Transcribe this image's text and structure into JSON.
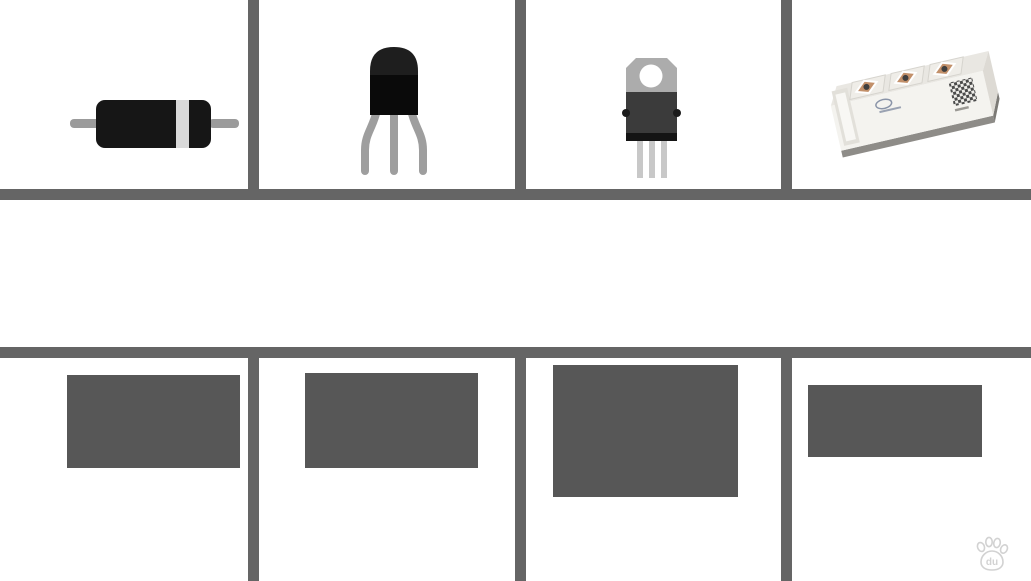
{
  "title": {
    "text": "什么是半导体",
    "color": "#5E5E5E"
  },
  "watermark": {
    "icon": "baidu-paw-icon",
    "handle": "@光淼君"
  },
  "palette": {
    "background": "#FFFFFF",
    "grid_line": "#656565",
    "title_text": "#5E5E5E",
    "diagram_border": "#575757",
    "yellow": "#F8DE4A",
    "blue": "#5B9DE2",
    "red": "#EC6A5B",
    "dark_dot": "#3D3D3D",
    "donut_ring": "#484848",
    "diode_body": "#161616",
    "diode_band": "#D9D9D9",
    "lead_gray": "#9B9B9B",
    "to92_body": "#1E1E1E",
    "to92_body_lower": "#0A0A0A",
    "to220_tab": "#ACACAC",
    "to220_body": "#3B3B3B",
    "to220_legs": "#C8C8C8",
    "module_body": "#F4F3EF",
    "module_top": "#E9E7E2",
    "module_end": "#DDDAD4",
    "module_base": "#8E8C88",
    "copper": "#C2906A"
  },
  "top_row": [
    {
      "icon": "axial-diode-icon"
    },
    {
      "icon": "to92-transistor-icon"
    },
    {
      "icon": "to220-package-icon"
    },
    {
      "icon": "igbt-power-module-icon"
    }
  ],
  "diagrams": {
    "conductor_insulator": {
      "left": {
        "bg": "yellow",
        "atom": "donut",
        "cols_pct": [
          26,
          74
        ],
        "rows_pct": [
          16,
          50,
          84
        ]
      },
      "right": {
        "bg": "blue",
        "atom": "red",
        "cols_pct": [
          28,
          72
        ],
        "rows_pct": [
          17,
          50,
          83
        ]
      }
    },
    "pn_junction": {
      "sections": [
        {
          "bg": "blue",
          "pattern": "dense-red-grid",
          "cols": 4,
          "rows": 7
        },
        {
          "bg": "yellow",
          "pattern": "scattered-dark",
          "dots_pct": [
            [
              45,
              8
            ],
            [
              75,
              23
            ],
            [
              32,
              40
            ],
            [
              68,
              55
            ],
            [
              30,
              71
            ],
            [
              62,
              88
            ]
          ]
        },
        {
          "bg": "blue",
          "pattern": "scattered-red",
          "dots_pct": [
            [
              22,
              9
            ],
            [
              80,
              9
            ],
            [
              40,
              24
            ],
            [
              58,
              24
            ],
            [
              18,
              40
            ],
            [
              84,
              42
            ],
            [
              42,
              55
            ],
            [
              58,
              55
            ],
            [
              22,
              70
            ],
            [
              86,
              70
            ],
            [
              44,
              87
            ],
            [
              58,
              87
            ]
          ]
        }
      ]
    },
    "doped_crystal": {
      "bg": "yellow",
      "wells": [
        {
          "x": 10,
          "w": 52,
          "h": 42,
          "dots_pct": [
            [
              22,
              28
            ],
            [
              76,
              28
            ],
            [
              16,
              70
            ],
            [
              48,
              70
            ],
            [
              82,
              70
            ]
          ]
        },
        {
          "x": 108,
          "w": 52,
          "h": 42,
          "dots_pct": [
            [
              20,
              28
            ],
            [
              50,
              28
            ],
            [
              80,
              28
            ],
            [
              18,
              70
            ],
            [
              72,
              70
            ]
          ]
        }
      ],
      "field_dots": [
        [
          37,
          7,
          "d"
        ],
        [
          45,
          7,
          "d"
        ],
        [
          57,
          7,
          "d"
        ],
        [
          34,
          18,
          "d"
        ],
        [
          42,
          18,
          "r"
        ],
        [
          50,
          18,
          "d"
        ],
        [
          58,
          18,
          "d"
        ],
        [
          42,
          29,
          "d"
        ],
        [
          57,
          29,
          "d"
        ],
        [
          5,
          44,
          "d"
        ],
        [
          19,
          44,
          "d"
        ],
        [
          27,
          44,
          "d"
        ],
        [
          35,
          44,
          "r"
        ],
        [
          43,
          44,
          "d"
        ],
        [
          50,
          44,
          "d"
        ],
        [
          63,
          44,
          "d"
        ],
        [
          71,
          44,
          "d"
        ],
        [
          83,
          44,
          "d"
        ],
        [
          91,
          44,
          "d"
        ],
        [
          5,
          55,
          "d"
        ],
        [
          18,
          55,
          "d"
        ],
        [
          32,
          55,
          "d"
        ],
        [
          40,
          55,
          "r"
        ],
        [
          49,
          55,
          "d"
        ],
        [
          56,
          55,
          "d"
        ],
        [
          72,
          55,
          "r"
        ],
        [
          80,
          55,
          "d"
        ],
        [
          3,
          66,
          "d"
        ],
        [
          10,
          66,
          "d"
        ],
        [
          17,
          66,
          "d"
        ],
        [
          25,
          66,
          "r"
        ],
        [
          32,
          66,
          "d"
        ],
        [
          39,
          66,
          "d"
        ],
        [
          46,
          66,
          "d"
        ],
        [
          53,
          66,
          "d"
        ],
        [
          60,
          66,
          "d"
        ],
        [
          73,
          66,
          "d"
        ],
        [
          81,
          66,
          "r"
        ],
        [
          89,
          66,
          "d"
        ],
        [
          6,
          77,
          "d"
        ],
        [
          26,
          77,
          "d"
        ],
        [
          33,
          77,
          "d"
        ],
        [
          40,
          77,
          "r"
        ],
        [
          47,
          77,
          "d"
        ],
        [
          54,
          77,
          "d"
        ],
        [
          60,
          77,
          "r"
        ],
        [
          67,
          77,
          "d"
        ],
        [
          77,
          77,
          "r"
        ],
        [
          84,
          77,
          "d"
        ],
        [
          27,
          88,
          "d"
        ],
        [
          34,
          88,
          "d"
        ],
        [
          47,
          88,
          "d"
        ],
        [
          59,
          88,
          "d"
        ],
        [
          73,
          88,
          "d"
        ],
        [
          89,
          88,
          "d"
        ]
      ]
    },
    "stripes": {
      "bars": [
        "yellow",
        "blue",
        "yellow",
        "blue"
      ]
    }
  }
}
